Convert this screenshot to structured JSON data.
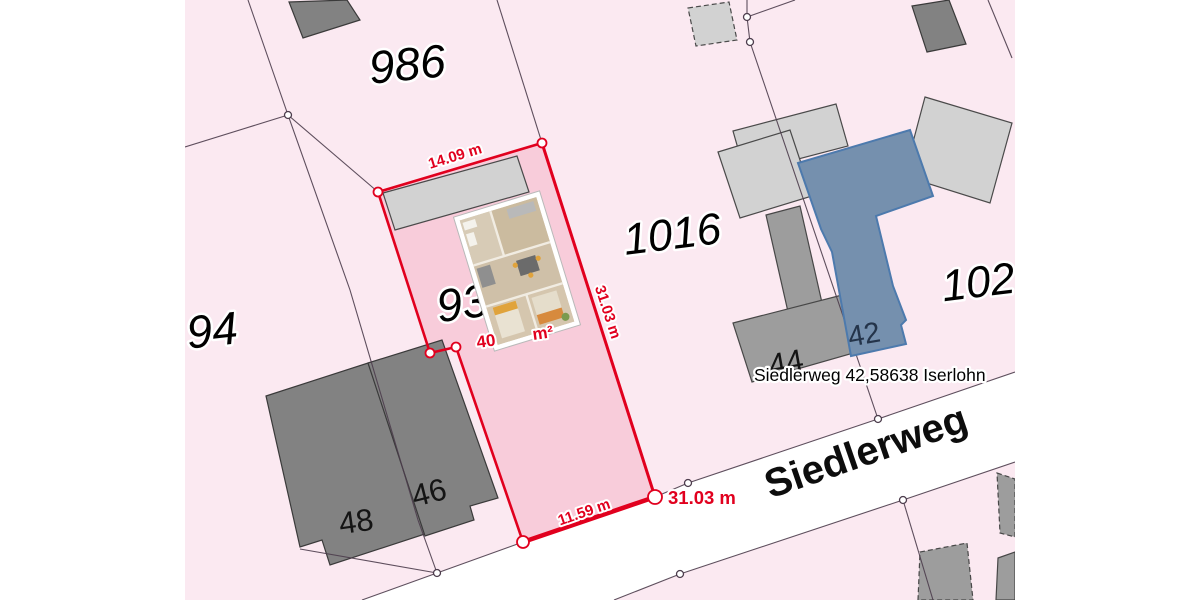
{
  "colors": {
    "map_background": "#fbe9f1",
    "selected_parcel_fill": "#f8ccda",
    "parcel_outline_red": "#e1001e",
    "boundary_line": "#4d3d4d",
    "street_fill": "#ffffff",
    "building_dark": "#828282",
    "building_medium": "#9d9d9d",
    "building_light": "#d2d2d2",
    "selected_building_fill": "#7590ae",
    "selected_building_stroke": "#4d7aad",
    "measurement_text": "#e1001e",
    "house_number_on_blue": "#24344a"
  },
  "parcels": {
    "n986": "986",
    "n1016": "1016",
    "n102": "102",
    "n94": "94",
    "n93": "93"
  },
  "houses": {
    "n48": "48",
    "n46": "46",
    "n44": "44",
    "n42": "42"
  },
  "street": {
    "name": "Siedlerweg"
  },
  "address_label": "Siedlerweg 42,58638 Iserlohn",
  "measurements": {
    "top_edge": "14.09 m",
    "right_edge": "31.03 m",
    "bottom_edge": "11.59 m",
    "bottom_total": "31.03 m",
    "area_prefix": "40",
    "area_suffix": "m²"
  }
}
